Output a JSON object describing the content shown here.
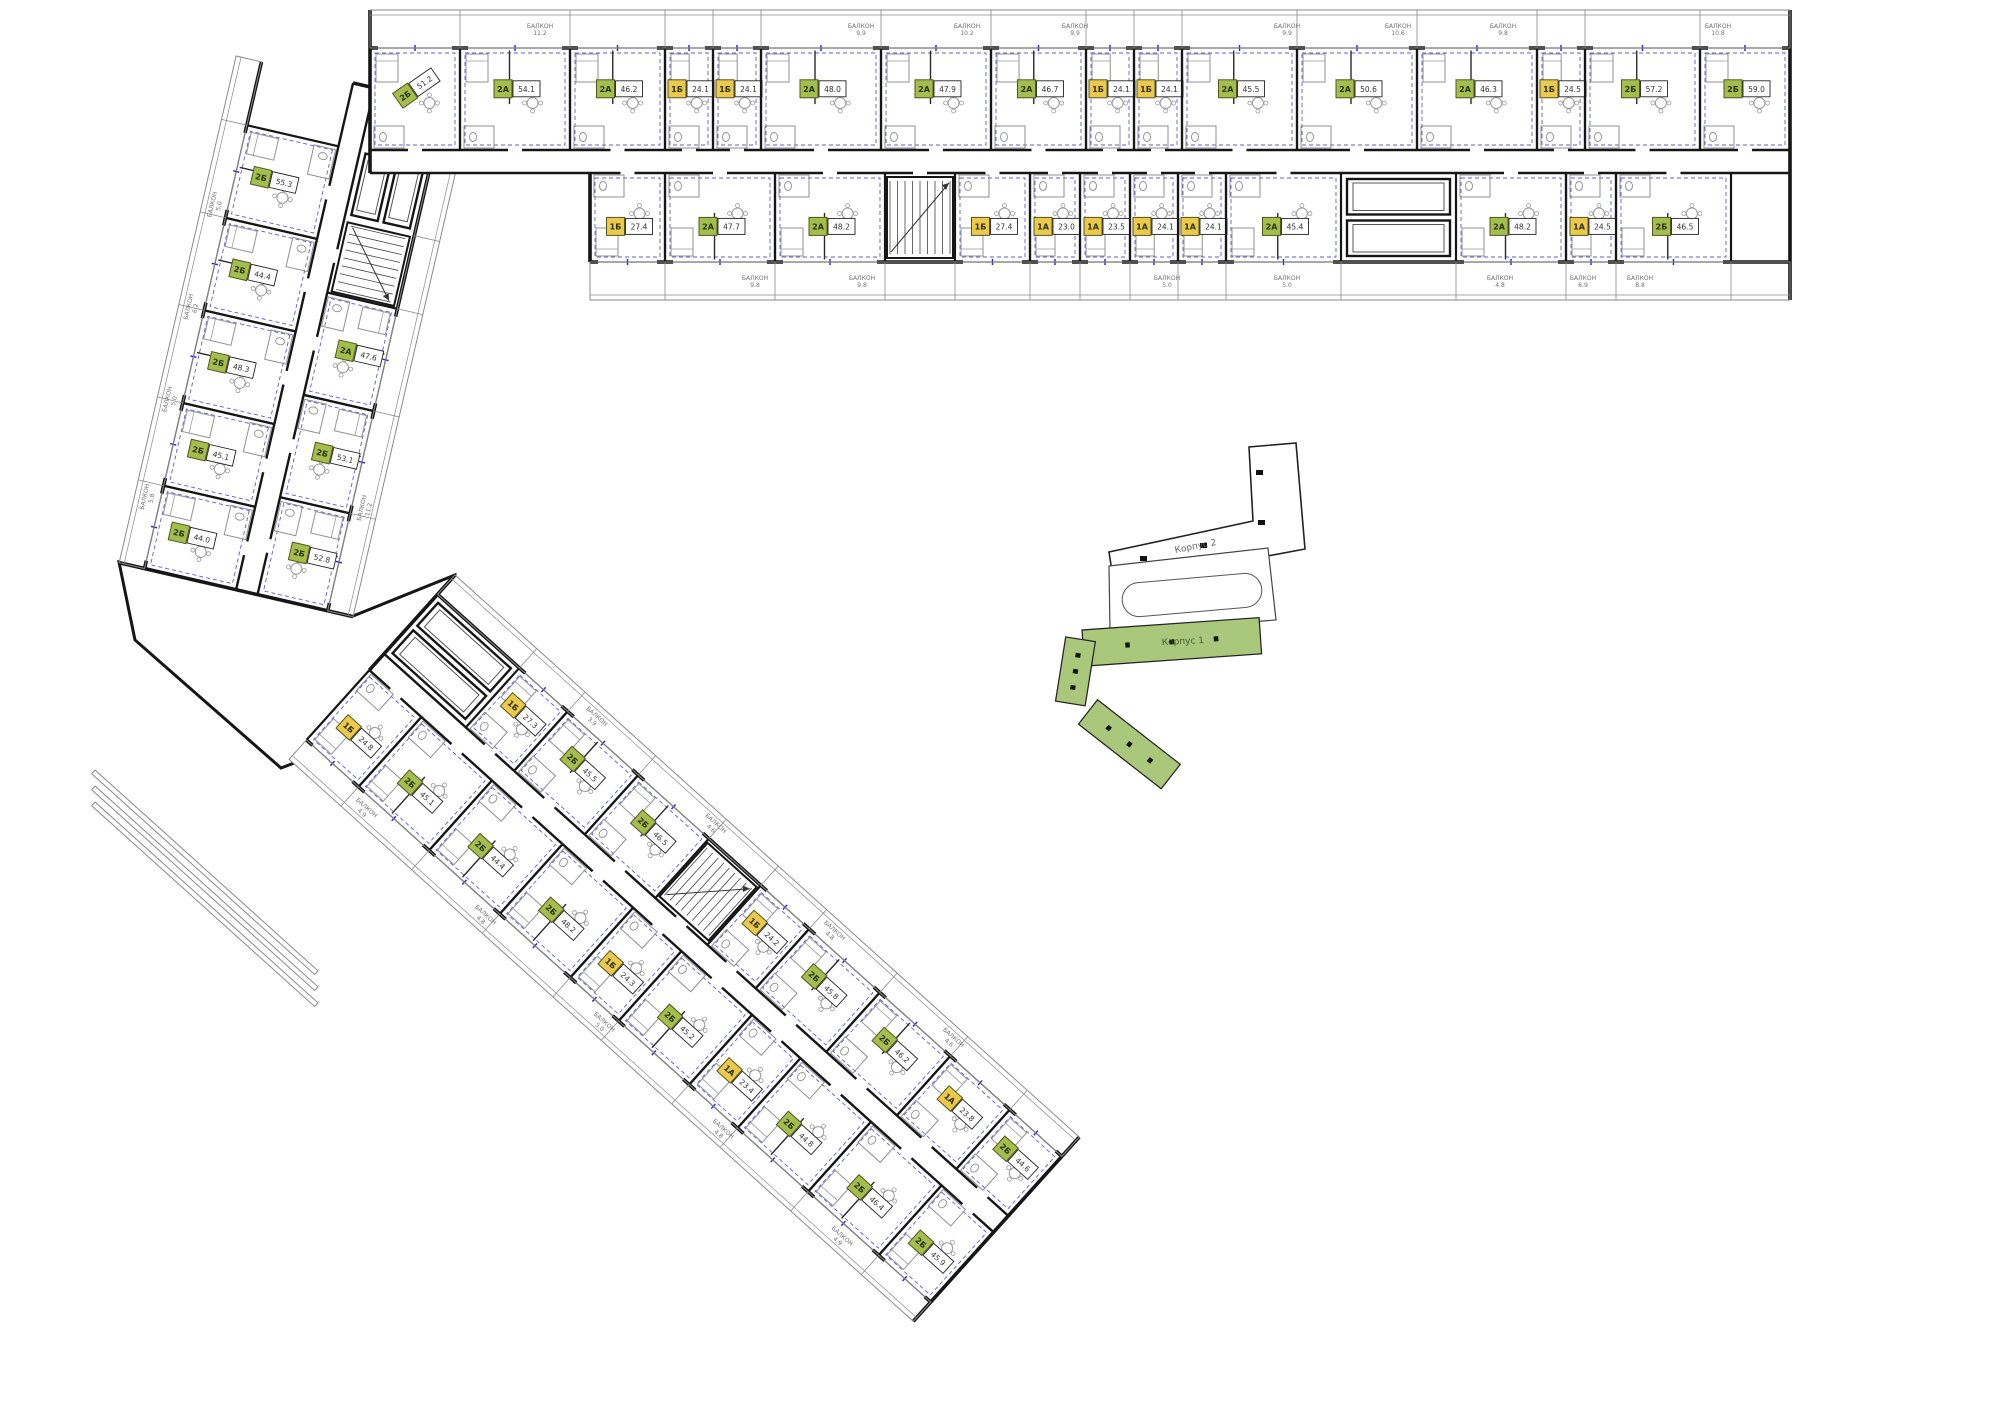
{
  "palette": {
    "wall": "#161616",
    "furniture": "#9a9a9a",
    "fixture": "#8f8f8f",
    "wiring_blue": "#2626cc",
    "badge_green": "#a2bf4e",
    "badge_yellow": "#eac94d",
    "badge_border": "#55551f",
    "badge_text": "#2f2f12",
    "area_text": "#333333",
    "balcony_line": "#8a8a8a",
    "balcony_text": "#6f6f6f",
    "minimap_green": "#a9c87b",
    "minimap_outline": "#222222",
    "minimap_text": "#666666"
  },
  "labels": {
    "balcony": "БАЛКОН"
  },
  "minimap": {
    "korpus1_label": "Корпус 1",
    "korpus2_label": "Корпус 2"
  },
  "wings": [
    {
      "id": "top-wing",
      "x": 370,
      "y": 10,
      "angle": 0,
      "length": 1420,
      "width": 290,
      "rows": {
        "balcA": [
          0,
          38
        ],
        "unitsA": [
          38,
          140
        ],
        "corridor": [
          140,
          163
        ],
        "unitsB": [
          163,
          252
        ],
        "balcB": [
          252,
          290
        ]
      },
      "unitsA": [
        {
          "w": 90,
          "t": "2Б",
          "a": "51.2",
          "rot": -35
        },
        {
          "w": 110,
          "t": "2А",
          "a": "54.1"
        },
        {
          "w": 95,
          "t": "2А",
          "a": "46.2"
        },
        {
          "w": 48,
          "t": "1Б",
          "a": "24.1"
        },
        {
          "w": 48,
          "t": "1Б",
          "a": "24.1"
        },
        {
          "w": 120,
          "t": "2А",
          "a": "48.0"
        },
        {
          "w": 110,
          "t": "2А",
          "a": "47.9"
        },
        {
          "w": 95,
          "t": "2А",
          "a": "46.7"
        },
        {
          "w": 48,
          "t": "1Б",
          "a": "24.1"
        },
        {
          "w": 48,
          "t": "1Б",
          "a": "24.1"
        },
        {
          "w": 115,
          "t": "2А",
          "a": "45.5"
        },
        {
          "w": 120,
          "t": "2А",
          "a": "50.6"
        },
        {
          "w": 120,
          "t": "2А",
          "a": "46.3"
        },
        {
          "w": 48,
          "t": "1Б",
          "a": "24.5"
        },
        {
          "w": 115,
          "t": "2Б",
          "a": "57.2"
        },
        {
          "w": 90,
          "t": "2Б",
          "a": "59.0"
        }
      ],
      "unitsB": [
        {
          "w": 220,
          "kind": "void"
        },
        {
          "w": 75,
          "t": "1Б",
          "a": "27.4"
        },
        {
          "w": 110,
          "t": "2А",
          "a": "47.7"
        },
        {
          "w": 110,
          "t": "2А",
          "a": "48.2"
        },
        {
          "w": 70,
          "kind": "stairs"
        },
        {
          "w": 75,
          "t": "1Б",
          "a": "27.4"
        },
        {
          "w": 50,
          "t": "1А",
          "a": "23.0"
        },
        {
          "w": 50,
          "t": "1А",
          "a": "23.5"
        },
        {
          "w": 48,
          "t": "1А",
          "a": "24.1"
        },
        {
          "w": 48,
          "t": "1А",
          "a": "24.1"
        },
        {
          "w": 115,
          "t": "2А",
          "a": "45.4"
        },
        {
          "w": 115,
          "kind": "elev"
        },
        {
          "w": 110,
          "t": "2А",
          "a": "48.2"
        },
        {
          "w": 50,
          "t": "1А",
          "a": "24.5"
        },
        {
          "w": 115,
          "t": "2Б",
          "a": "46.5"
        },
        {
          "w": 59,
          "kind": "void"
        }
      ],
      "balcALabels": [
        {
          "x": 170,
          "a": "11.2"
        },
        {
          "x": 491,
          "a": "9.9"
        },
        {
          "x": 597,
          "a": "10.2"
        },
        {
          "x": 705,
          "a": "9.9"
        },
        {
          "x": 917,
          "a": "9.9"
        },
        {
          "x": 1028,
          "a": "10.6"
        },
        {
          "x": 1133,
          "a": "9.8"
        },
        {
          "x": 1348,
          "a": "10.8"
        }
      ],
      "balcBLabels": [
        {
          "x": 385,
          "a": "9.8"
        },
        {
          "x": 492,
          "a": "9.8"
        },
        {
          "x": 797,
          "a": "5.0"
        },
        {
          "x": 917,
          "a": "5.0"
        },
        {
          "x": 1130,
          "a": "4.8"
        },
        {
          "x": 1213,
          "a": "6.9"
        },
        {
          "x": 1270,
          "a": "8.8"
        }
      ]
    },
    {
      "id": "left-wing",
      "x": 470,
      "y": 110,
      "angle": 103,
      "length": 520,
      "width": 240,
      "badgeRot": -90,
      "labelRot": 180,
      "rows": {
        "balcA": [
          0,
          26
        ],
        "unitsA": [
          26,
          98
        ],
        "corridor": [
          98,
          120
        ],
        "unitsB": [
          120,
          214
        ],
        "balcB": [
          214,
          240
        ]
      },
      "unitsA": [
        {
          "w": 60,
          "kind": "void"
        },
        {
          "w": 75,
          "kind": "elev"
        },
        {
          "w": 75,
          "kind": "stairs"
        },
        {
          "w": 105,
          "t": "2А",
          "a": "47.6"
        },
        {
          "w": 105,
          "t": "2Б",
          "a": "53.1"
        },
        {
          "w": 100,
          "t": "2Б",
          "a": "52.8"
        }
      ],
      "unitsB": [
        {
          "w": 65,
          "kind": "void"
        },
        {
          "w": 95,
          "t": "2Б",
          "a": "55.3"
        },
        {
          "w": 95,
          "t": "2Б",
          "a": "44.4"
        },
        {
          "w": 95,
          "t": "2Б",
          "a": "48.3"
        },
        {
          "w": 85,
          "t": "2Б",
          "a": "45.1"
        },
        {
          "w": 85,
          "t": "2Б",
          "a": "44.0"
        }
      ],
      "balcALabels": [
        {
          "x": 412,
          "a": "11.2"
        }
      ],
      "balcBLabels": [
        {
          "x": 150,
          "a": "5.0"
        },
        {
          "x": 255,
          "a": "6.2"
        },
        {
          "x": 350,
          "a": "5.0"
        },
        {
          "x": 450,
          "a": "5.8"
        }
      ]
    },
    {
      "id": "bottom-wing",
      "x": 455,
      "y": 575,
      "angle": 42,
      "length": 840,
      "width": 248,
      "rows": {
        "balcA": [
          0,
          26
        ],
        "unitsA": [
          26,
          106
        ],
        "corridor": [
          106,
          128
        ],
        "unitsB": [
          128,
          222
        ],
        "balcB": [
          222,
          248
        ]
      },
      "unitsA": [
        {
          "w": 110,
          "kind": "elev"
        },
        {
          "w": 65,
          "t": "1Б",
          "a": "27.3"
        },
        {
          "w": 95,
          "t": "2Б",
          "a": "45.5"
        },
        {
          "w": 95,
          "t": "2Б",
          "a": "46.5"
        },
        {
          "w": 70,
          "kind": "stairs"
        },
        {
          "w": 65,
          "t": "1Б",
          "a": "24.2"
        },
        {
          "w": 95,
          "t": "2Б",
          "a": "45.8"
        },
        {
          "w": 95,
          "t": "2Б",
          "a": "46.2"
        },
        {
          "w": 80,
          "t": "1А",
          "a": "23.8"
        },
        {
          "w": 70,
          "t": "2Б",
          "a": "44.6"
        }
      ],
      "unitsB": [
        {
          "w": 70,
          "t": "1Б",
          "a": "24.8"
        },
        {
          "w": 95,
          "t": "2Б",
          "a": "45.1"
        },
        {
          "w": 95,
          "t": "2Б",
          "a": "44.4"
        },
        {
          "w": 95,
          "t": "2Б",
          "a": "48.2"
        },
        {
          "w": 65,
          "t": "1Б",
          "a": "24.3"
        },
        {
          "w": 95,
          "t": "2Б",
          "a": "45.2"
        },
        {
          "w": 65,
          "t": "1А",
          "a": "23.4"
        },
        {
          "w": 95,
          "t": "2Б",
          "a": "44.8"
        },
        {
          "w": 95,
          "t": "2Б",
          "a": "46.4"
        },
        {
          "w": 70,
          "t": "2Б",
          "a": "45.9"
        }
      ],
      "balcALabels": [
        {
          "x": 200,
          "a": "3.9"
        },
        {
          "x": 360,
          "a": "4.6"
        },
        {
          "x": 520,
          "a": "4.8"
        },
        {
          "x": 680,
          "a": "4.6"
        }
      ],
      "balcBLabels": [
        {
          "x": 90,
          "a": "4.9"
        },
        {
          "x": 250,
          "a": "4.8"
        },
        {
          "x": 410,
          "a": "5.0"
        },
        {
          "x": 570,
          "a": "4.8"
        },
        {
          "x": 730,
          "a": "4.9"
        }
      ]
    }
  ]
}
